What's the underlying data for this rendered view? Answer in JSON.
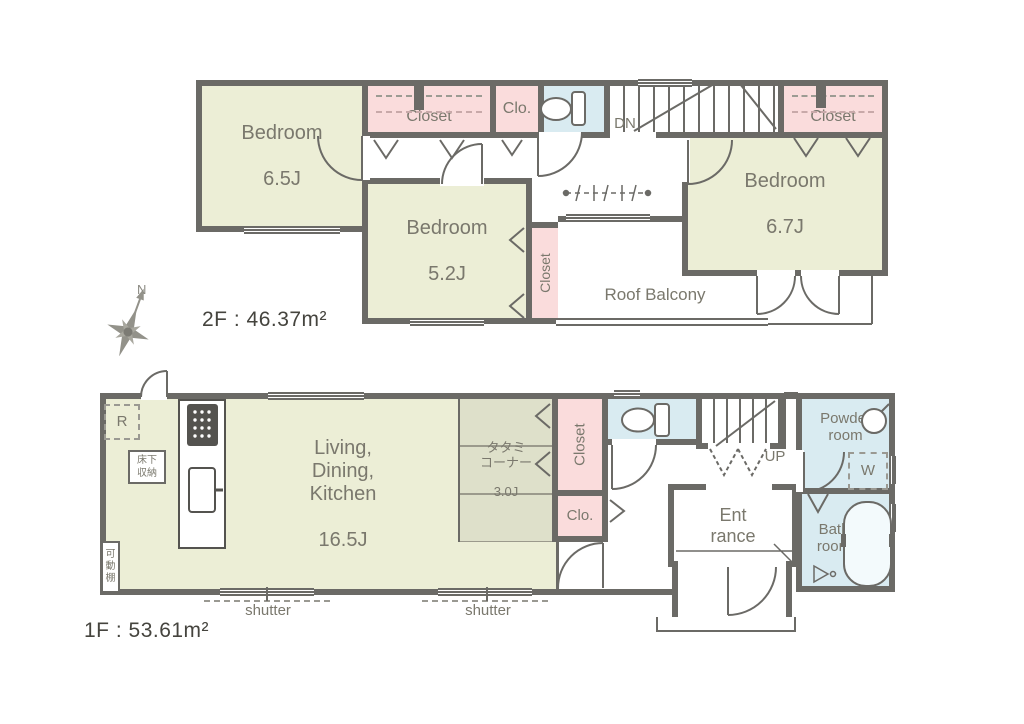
{
  "compass": {
    "north": "N"
  },
  "floor2": {
    "area_label": "2F : 46.37m²",
    "bedroom_a": {
      "name": "Bedroom",
      "size": "6.5J"
    },
    "bedroom_b": {
      "name": "Bedroom",
      "size": "5.2J"
    },
    "bedroom_c": {
      "name": "Bedroom",
      "size": "6.7J"
    },
    "closet_top": "Closet",
    "clo_top": "Clo.",
    "closet_side": "Closet",
    "closet_right": "Closet",
    "roof_balcony": "Roof Balcony",
    "stairs_down": "DN"
  },
  "floor1": {
    "area_label": "1F : 53.61m²",
    "ldk": {
      "name": "Living,\nDining,\nKitchen",
      "size": "16.5J"
    },
    "tatami": {
      "name": "タタミ\nコーナー",
      "size": "3.0J"
    },
    "closet": "Closet",
    "clo": "Clo.",
    "entrance": "Ent\nrance",
    "powder_room": "Powder\nroom",
    "bath_room": "Bath\nroom",
    "stairs_up": "UP",
    "washer": "W",
    "fridge": "R",
    "underfloor_storage": "床下\n収納",
    "movable_shelf": "可\n動\n棚",
    "shutter_left": "shutter",
    "shutter_right": "shutter"
  }
}
